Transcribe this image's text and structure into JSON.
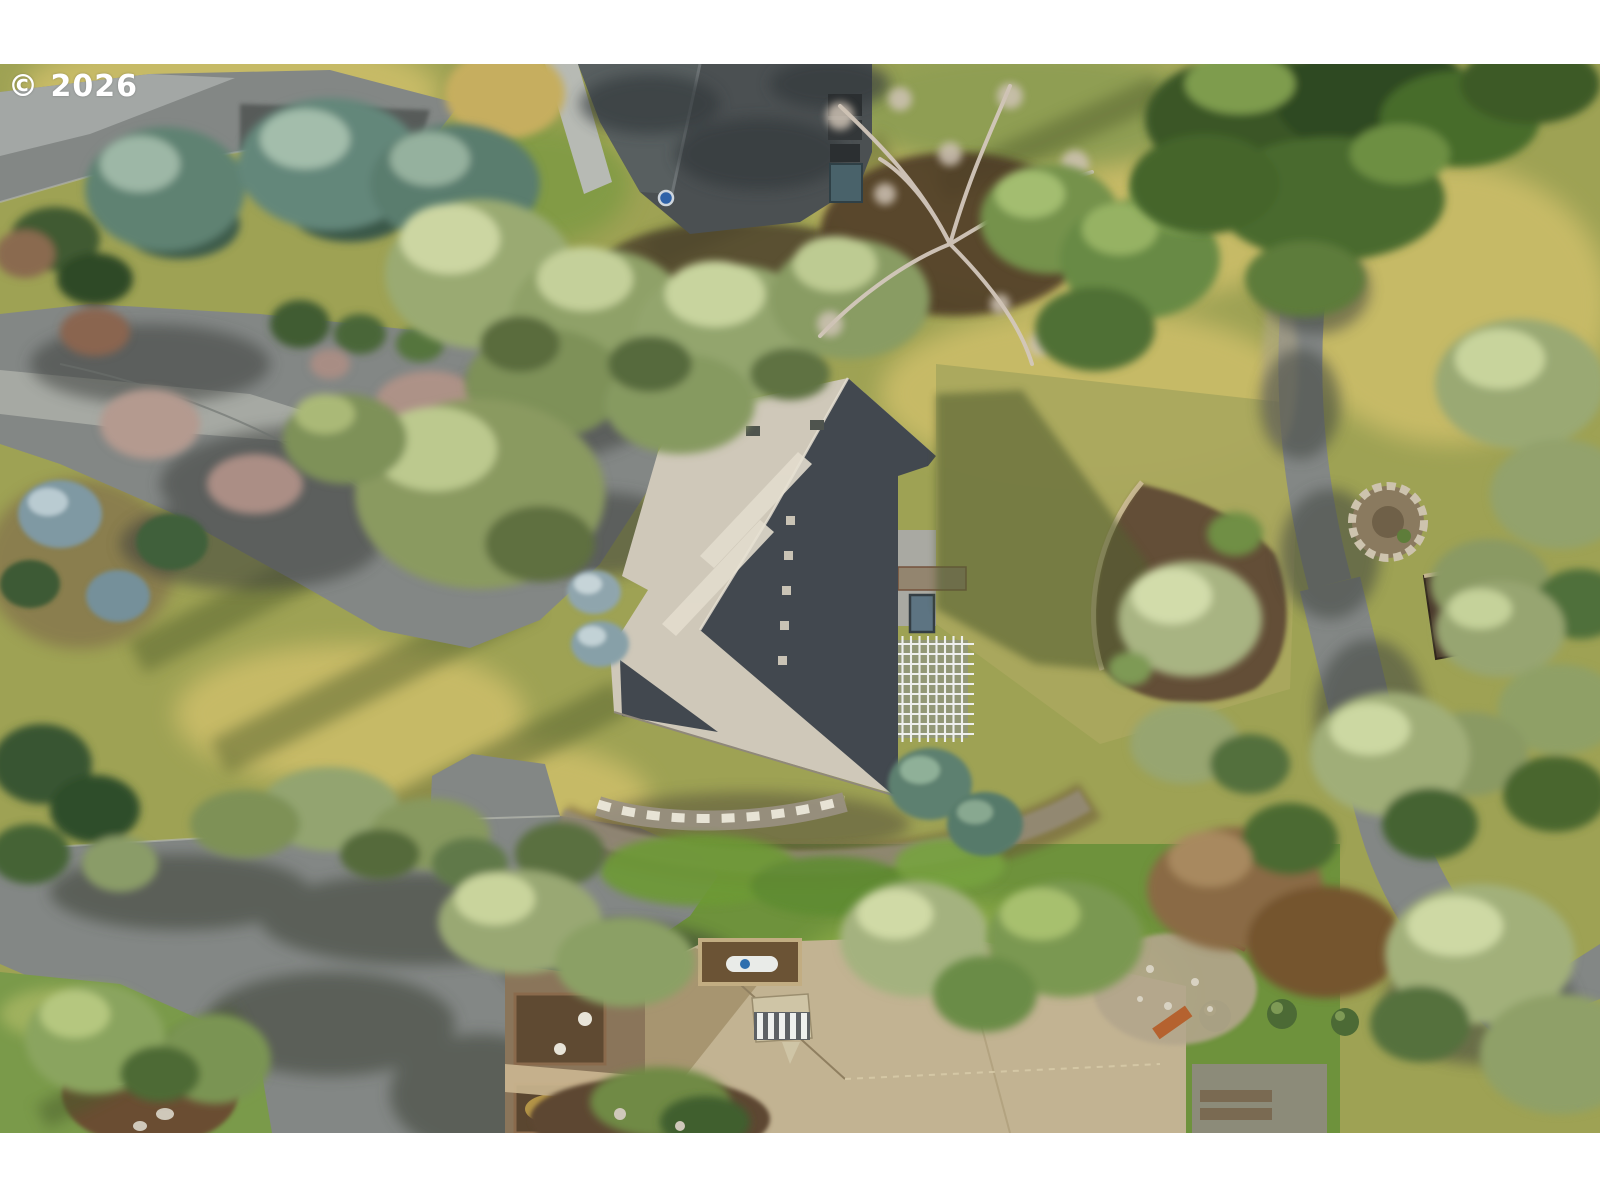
{
  "watermark": {
    "text": "© 2026",
    "color": "#ffffff"
  },
  "photo": {
    "kind": "aerial drone photograph",
    "subject": "Overhead view of a residential property: large hip-roof house with beige sunlit and dark slate shaded roof planes, white pergola and skylight, surrounded by driveways, curving asphalt roads, lawns, junipers, blue spruces and a neighboring tan-roof house with wood deck",
    "letterbox": "white bars above and below the photo",
    "features": [
      "central house roof (beige sunlit planes, dark slate shaded planes)",
      "white pergola lattice",
      "roof skylight",
      "neighboring charcoal-roof house at top",
      "neighboring tan shingle-roof house at bottom with wood deck and planters",
      "hot-tub under tan awning",
      "asphalt driveway with tree shadows",
      "curving asphalt road on right",
      "road fork with lawn island at bottom left",
      "circular stone fire-pit",
      "small garden shed",
      "dead bare tree with white branches",
      "blue spruce row",
      "sage-green juniper clusters",
      "dry-creek gravel bed with stepping-stone walkway",
      "orange bench on gravel patch",
      "golden dry grass and green lawns"
    ]
  },
  "palette": {
    "letterbox": "#ffffff",
    "grass_olive": "#9ea254",
    "grass_gold": "#c9bc68",
    "lawn_green": "#6e923c",
    "lawn_right": "#aaa85e",
    "asphalt": "#838785",
    "asphalt_sunlit": "#a3a7a5",
    "asphalt_shadow": "#454946",
    "concrete": "#a6a9a3",
    "roof_sunlit": "#cfc8b9",
    "roof_shadow": "#42484f",
    "roof_ridge": "#e2dccd",
    "roof_charcoal": "#4b5052",
    "roof_tan": "#c2b392",
    "roof_tan_shadow": "#a5946f",
    "pergola_white": "#f2f3f4",
    "skylight_blue": "#5d7482",
    "tree_sage": "#9dab76",
    "tree_green": "#6f8f4a",
    "tree_dark": "#3a5626",
    "tree_blue": "#5d8070",
    "tree_bare": "#d3c8bc",
    "mulch_brown": "#5f4936",
    "deck_wood": "#8a755a",
    "stone_ring": "#cdc3ae",
    "bench_orange": "#b5622f"
  }
}
